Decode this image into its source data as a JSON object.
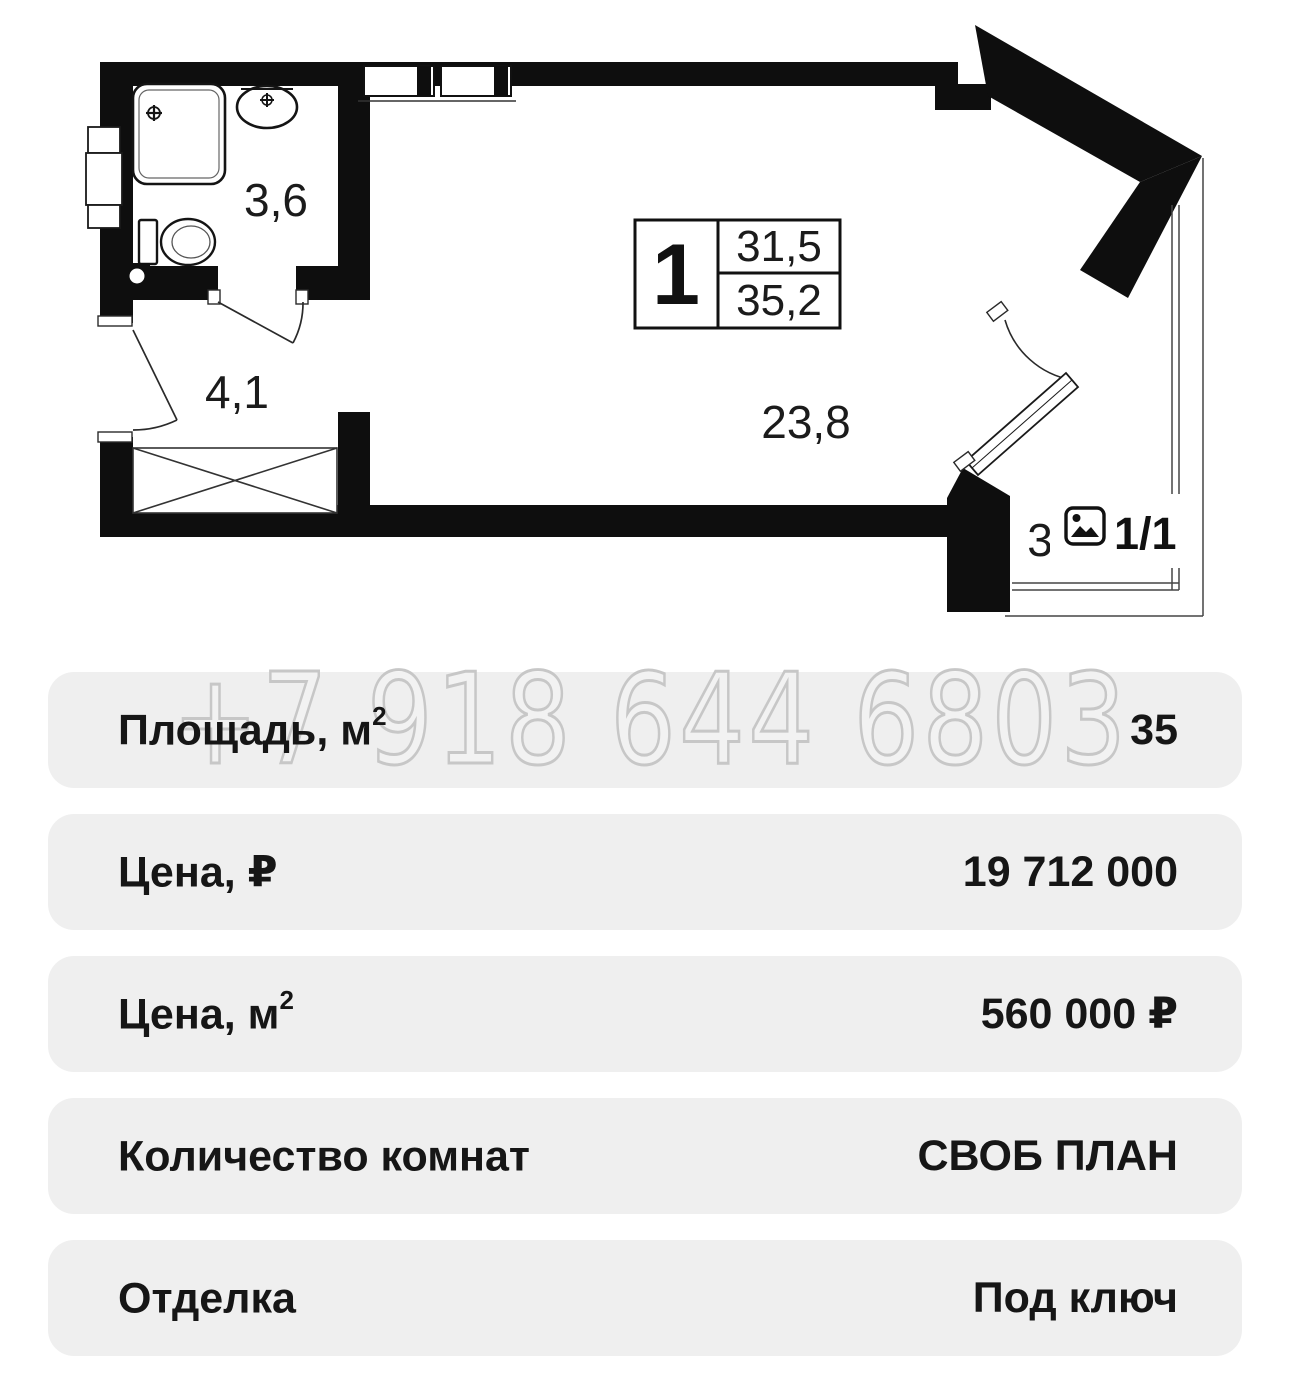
{
  "floor_plan": {
    "legend": {
      "rooms": "1",
      "area_living": "31,5",
      "area_total": "35,2"
    },
    "room_areas": {
      "bathroom": "3,6",
      "hallway": "4,1",
      "living_room": "23,8"
    },
    "photo_counter": {
      "current_total": "1/1",
      "partial_area_label": "3"
    }
  },
  "watermark": {
    "phone": "+7 918 644 6803"
  },
  "details": {
    "rows": [
      {
        "label": "Площадь, м",
        "sup": "2",
        "value": "35"
      },
      {
        "label": "Цена, ₽",
        "sup": "",
        "value": "19 712 000"
      },
      {
        "label": "Цена, м",
        "sup": "2",
        "value": "560 000 ₽"
      },
      {
        "label": "Количество комнат",
        "sup": "",
        "value": "СВОБ ПЛАН"
      },
      {
        "label": "Отделка",
        "sup": "",
        "value": "Под ключ"
      }
    ]
  },
  "colors": {
    "wall": "#0e0e0e",
    "row_bg": "#efefef",
    "text": "#161616",
    "watermark_stroke": "#c7c7c7"
  }
}
